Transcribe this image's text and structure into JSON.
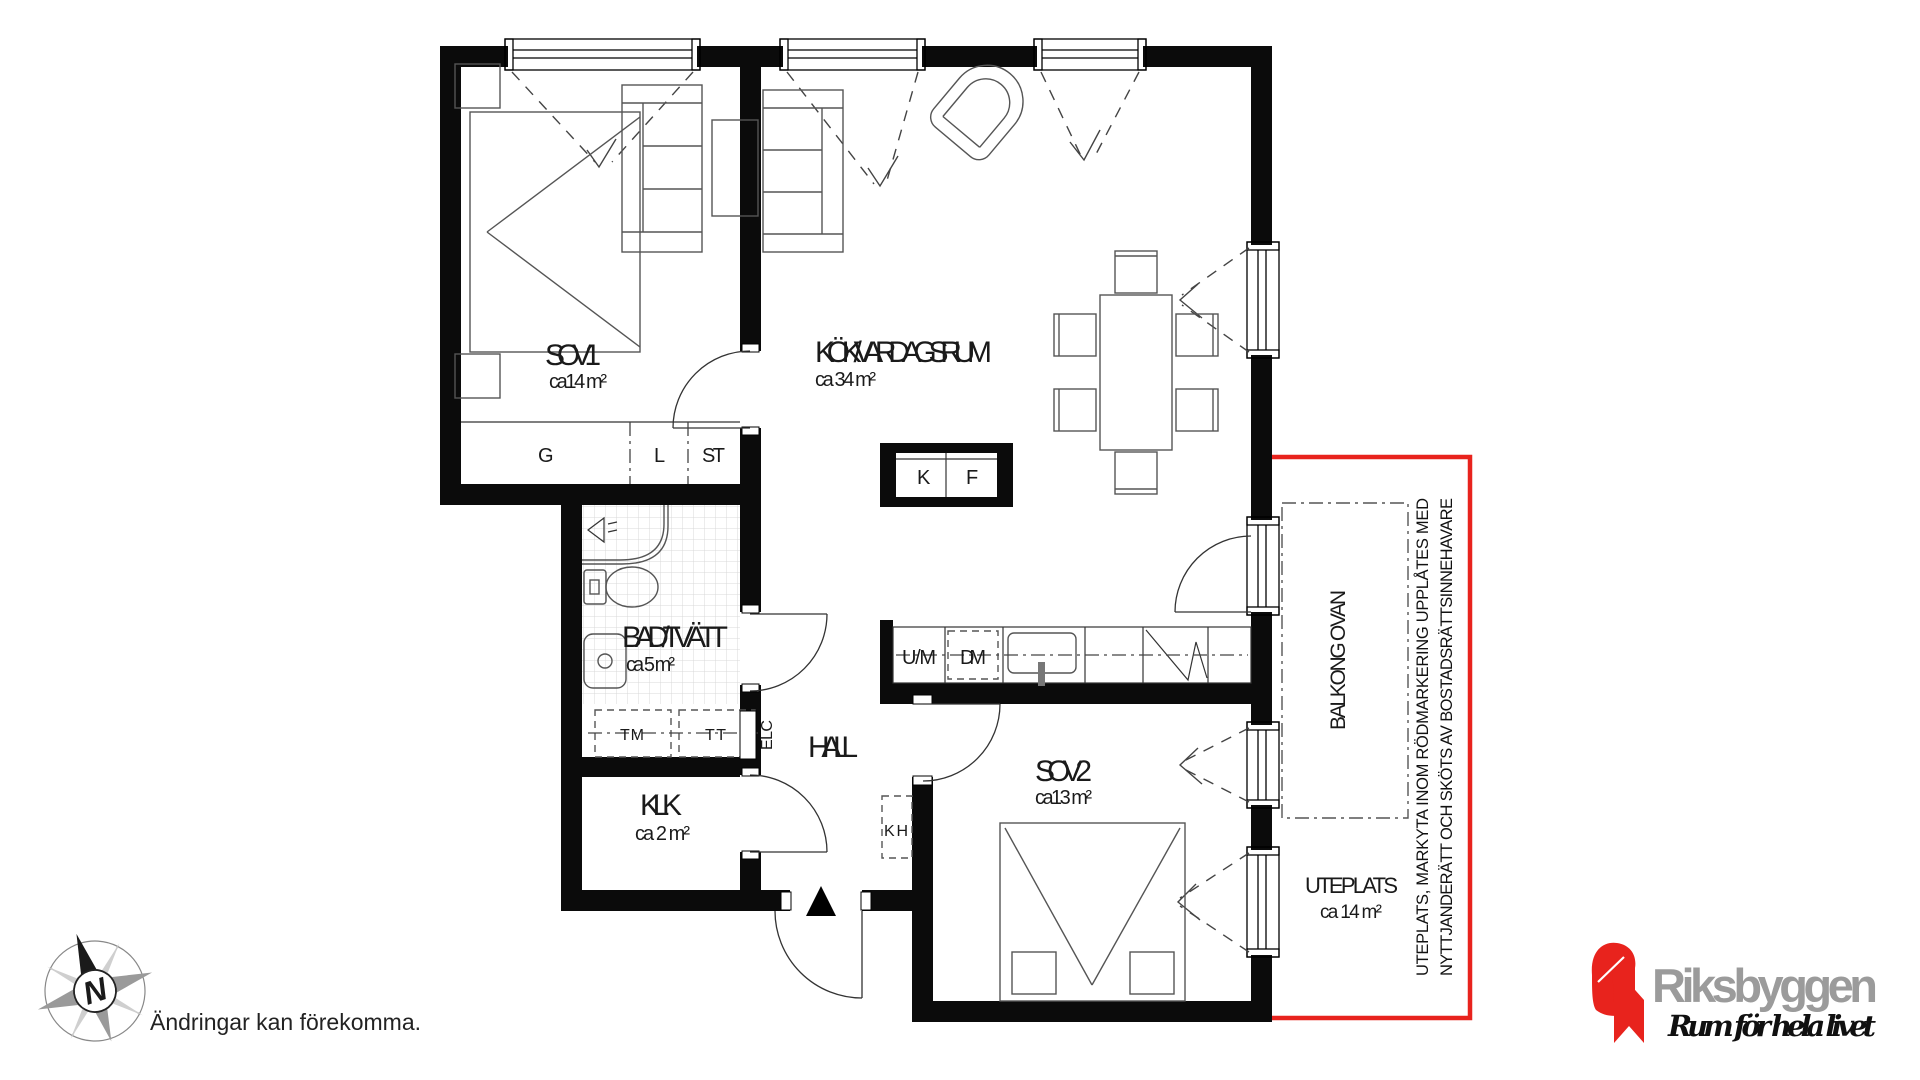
{
  "plan": {
    "rooms": [
      {
        "id": "sov1",
        "name": "SOV 1",
        "area": "ca14 m²"
      },
      {
        "id": "kok",
        "name": "KÖK/VARDAGSRUM",
        "area": "ca 34 m²"
      },
      {
        "id": "bad",
        "name": "BAD/TVÄTT",
        "area": "ca 5 m²"
      },
      {
        "id": "hall",
        "name": "HALL",
        "area": ""
      },
      {
        "id": "klk",
        "name": "KLK",
        "area": "ca 2 m²"
      },
      {
        "id": "sov2",
        "name": "SOV 2",
        "area": "ca13 m²"
      },
      {
        "id": "uteplats",
        "name": "UTEPLATS",
        "area": "ca 14 m²"
      },
      {
        "id": "balkong",
        "name": "BALKONG OVAN"
      }
    ],
    "fixtures": {
      "wardrobe": "G",
      "linen": "L",
      "st": "ST",
      "fridge": "K",
      "freezer": "F",
      "oven_micro": "U/M",
      "dishwasher": "DM",
      "washer": "TM",
      "dryer": "TT",
      "electrical": "ELC",
      "coat_rack": "KH"
    },
    "note": {
      "line1": "UTEPLATS, MARKYTA INOM RÖDMARKERING UPPLÅTES MED",
      "line2": "NYTTJANDERÄTT OCH SKÖTS AV BOSTADSRÄTTSINNEHAVARE"
    },
    "compass": {
      "north": "N"
    },
    "disclaimer": "Ändringar kan förekomma.",
    "colors": {
      "red": "#e8231d",
      "wall": "#0b0b0b",
      "logo_gray": "#9b9b9b",
      "tile": "#d9d9d9"
    }
  },
  "footer": {
    "brand": "Riksbyggen",
    "tagline": "Rum för hela livet"
  }
}
